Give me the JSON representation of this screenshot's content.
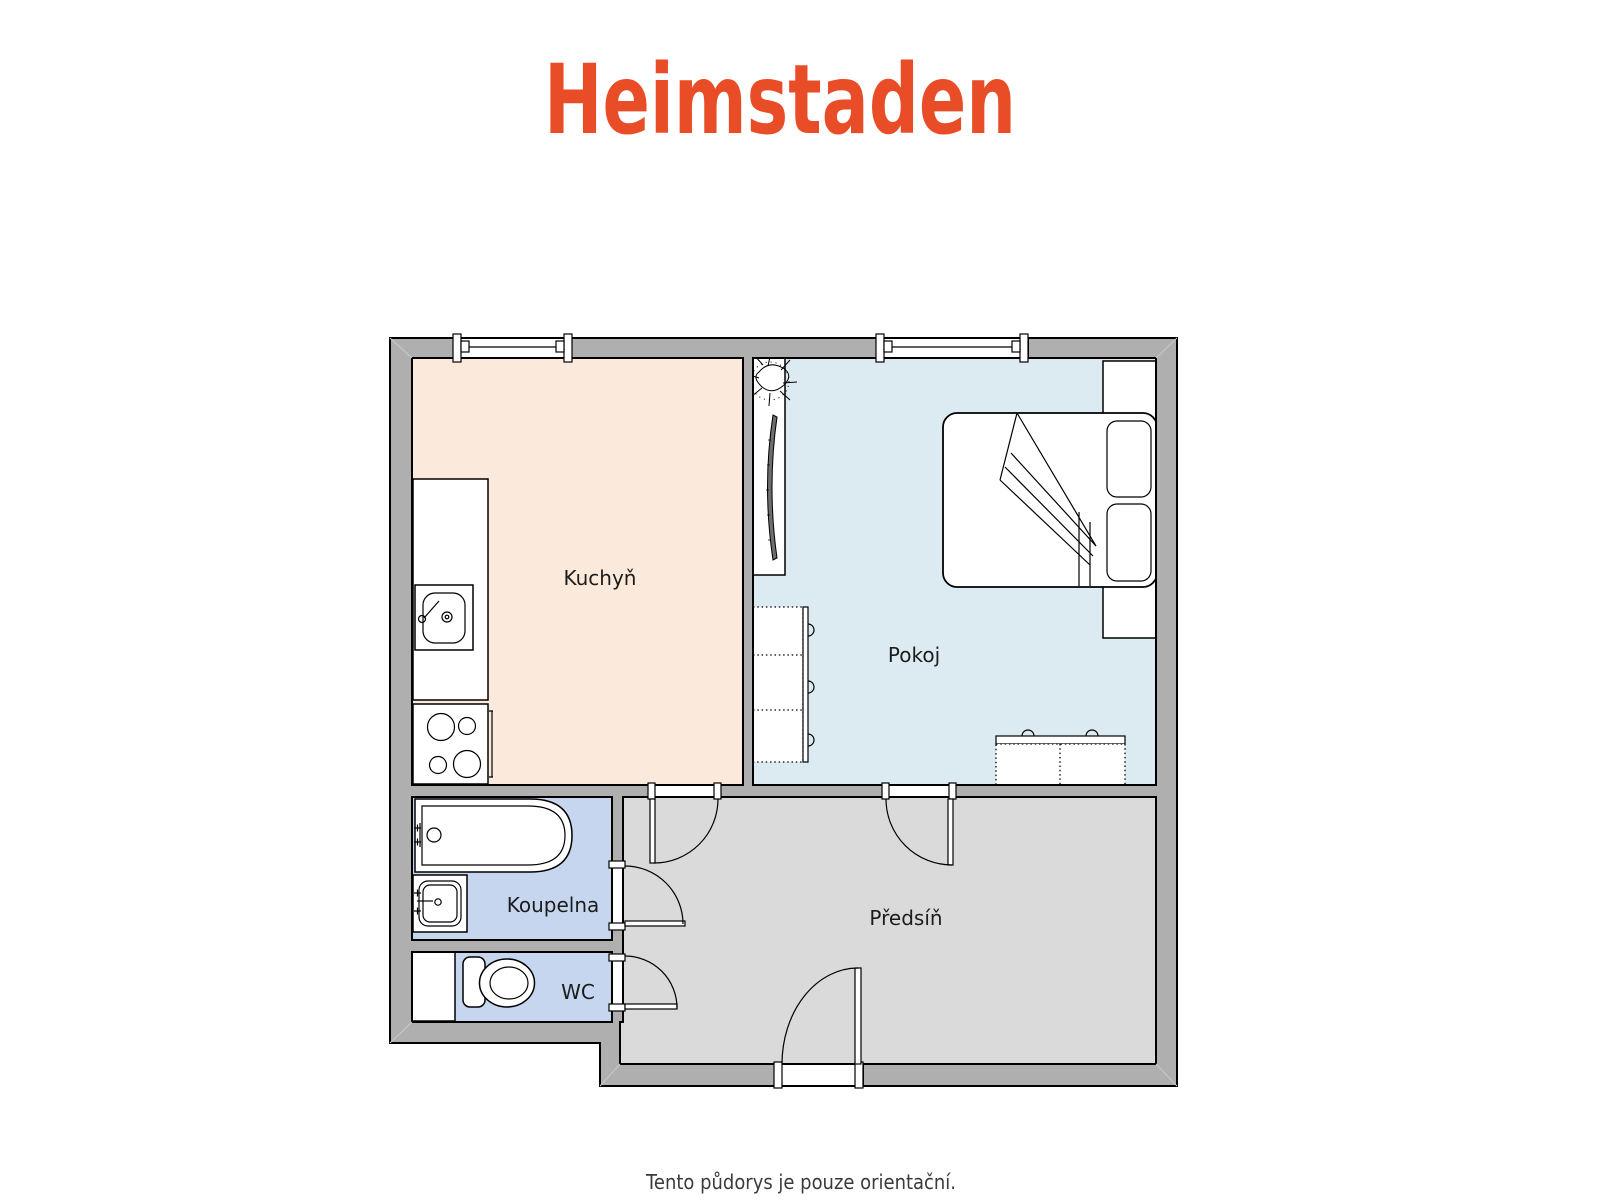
{
  "header": {
    "logo_text": "Heimstaden",
    "brand_color": "#E94D27"
  },
  "floorplan": {
    "wall_color": "#AFAFAF",
    "outline_color": "#000000",
    "rooms": [
      {
        "name": "Kuchyň",
        "type": "kitchen",
        "fill": "#FBEADC"
      },
      {
        "name": "Pokoj",
        "type": "room",
        "fill": "#DCEBF2"
      },
      {
        "name": "Koupelna",
        "type": "bathroom",
        "fill": "#C6D6EE"
      },
      {
        "name": "WC",
        "type": "toilet",
        "fill": "#C6D6EE"
      },
      {
        "name": "Předsíň",
        "type": "hallway",
        "fill": "#DADADA"
      }
    ],
    "window_count": "2",
    "door_count": "5",
    "fixtures": [
      "plant",
      "tv",
      "bed",
      "pillows",
      "wardrobe",
      "dresser",
      "kitchen-counter",
      "kitchen-sink",
      "stove",
      "bathtub",
      "washbasin",
      "toilet-bowl",
      "shaft"
    ]
  },
  "footer": {
    "disclaimer": "Tento půdorys je pouze orientační."
  }
}
